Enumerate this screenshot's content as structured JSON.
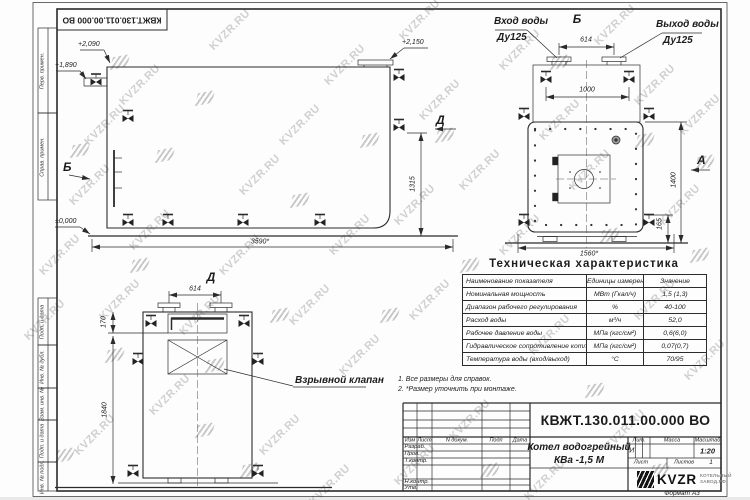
{
  "watermark": {
    "text": "KVZR.RU"
  },
  "frame": {
    "corner_stamp": "КВЖТ.130.011.00.000 ВО",
    "format_note": "Формат А3",
    "left_stamps": [
      "Перв. примен.",
      "Справ. примен.",
      "Подп. и дата",
      "Инв. № дубл.",
      "Взам. инв. №",
      "Подп. и дата",
      "Инв. № подл."
    ]
  },
  "side_view": {
    "elev_top_valve": "+2,090",
    "elev_pipe": "+1,890",
    "elev_flange": "+2,150",
    "elev_ground": "±0,000",
    "arrow_b": "Б",
    "arrow_d": "Д",
    "dim_length": "3590*",
    "dim_height": "1315"
  },
  "front_view": {
    "view_title": "Б",
    "inlet_line1": "Вход воды",
    "inlet_line2": "Ду125",
    "outlet_line1": "Выход воды",
    "outlet_line2": "Ду125",
    "dim_flanges": "614",
    "dim_valves": "1000",
    "dim_height": "1400",
    "dim_base": "165",
    "dim_width": "1560*",
    "arrow_a": "А"
  },
  "section_view": {
    "view_title": "Д",
    "dim_flanges": "614",
    "dim_register": "170",
    "dim_height": "1840",
    "explosion_valve_callout": "Взрывной клапан"
  },
  "notes": {
    "line1": "1. Все размеры для справок.",
    "line2": "2. *Размер уточнить при монтаже."
  },
  "spec_table": {
    "title": "Техническая характеристика",
    "headers": [
      "Наименование показателя",
      "Единицы измерения",
      "Значение"
    ],
    "rows": [
      [
        "Номинальная мощность",
        "МВт (Гкал/ч)",
        "1,5 (1,3)"
      ],
      [
        "Диапазон рабочего регулирования",
        "%",
        "40-100"
      ],
      [
        "Расход воды",
        "м³/ч",
        "52,0"
      ],
      [
        "Рабочее давление воды",
        "МПа (кгс/см²)",
        "0,6(6,0)"
      ],
      [
        "Гидравлическое сопротивление котла",
        "МПа (кгс/см²)",
        "0,07(0,7)"
      ],
      [
        "Температура воды (вход/выход)",
        "°С",
        "70/95"
      ]
    ]
  },
  "title_block": {
    "doc_number": "КВЖТ.130.011.00.000 ВО",
    "product_line1": "Котел водогрейный",
    "product_line2": "КВа -1,5  М",
    "col_izm": "Изм",
    "col_list": "Лист",
    "col_docnum": "N докум.",
    "col_podp": "Подп",
    "col_data": "Дата",
    "row_razrab": "Разраб.",
    "row_prov": "Пров.",
    "row_tkontr": "Т.контр.",
    "row_nkontr": "Н.контр.",
    "row_utv": "Утв.",
    "lit_header": "Лит.",
    "mass_header": "Масса",
    "scale_header": "Масштаб",
    "lit_value": "И",
    "scale_value": "1:20",
    "sheet_label": "Лист",
    "sheets_label": "Листов",
    "sheets_value": "1",
    "logo_text": "KVZR",
    "logo_sub1": "КОТЕЛЬНЫЙ",
    "logo_sub2": "ЗАВОД.РФ"
  },
  "colors": {
    "line": "#2b2b2b",
    "watermark": "#c9c9c9",
    "paper": "#fdfdfd"
  }
}
